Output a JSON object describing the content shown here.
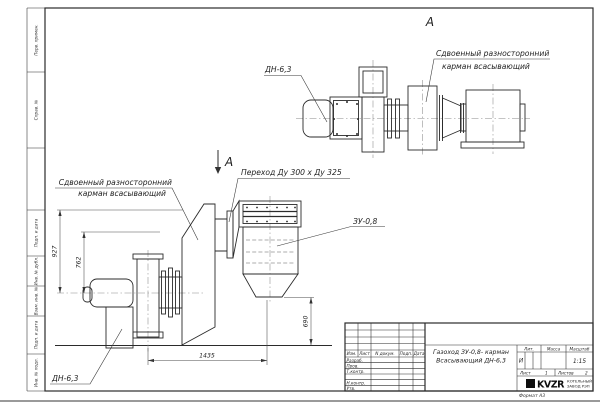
{
  "colors": {
    "ink": "#2b2b2b",
    "paper": "#ffffff"
  },
  "frame": {
    "side_columns": {
      "top": [
        "Перв. примен.",
        "Справ. №"
      ],
      "bottom": [
        "Подп. и дата",
        "Инв. № дубл.",
        "Взам. инв. №",
        "Подп. и дата",
        "Инв. № подл."
      ]
    },
    "format_note": "Формат  А3"
  },
  "drawing": {
    "view_label_top": "А",
    "section_label": "А",
    "labels": {
      "top_fan": "ДН-6,3",
      "top_pocket_line1": "Сдвоенный разносторонний",
      "top_pocket_line2": "карман всасывающий",
      "main_pocket_line1": "Сдвоенный разносторонний",
      "main_pocket_line2": "карман всасывающий",
      "transition": "Переход Ду  300 х  Ду 325",
      "collector": "ЗУ-0,8",
      "main_fan": "ДН-6,3"
    },
    "dimensions": {
      "total_height": "927",
      "duct_height": "762",
      "length": "1435",
      "outlet_height": "690"
    }
  },
  "title_block": {
    "title_line1": "Газоход ЗУ-0,8- карман",
    "title_line2": "Всасывающий ДН-6,3",
    "rev_header": [
      "Изм.",
      "Лист",
      "N докум.",
      "Подп.",
      "Дата"
    ],
    "row_labels": [
      "Разраб.",
      "Пров.",
      "Т.контр.",
      "Н.контр.",
      "Утв."
    ],
    "lit_label": "Лит.",
    "lit_value": "И",
    "mass_label": "Масса",
    "scale_label": "Масштаб",
    "scale_value": "1:15",
    "sheet_label": "Лист",
    "sheet_value": "1",
    "sheets_label": "Листов",
    "sheets_value": "2",
    "logo_text": "KVZR",
    "company_line1": "КОТЕЛЬНЫЙ",
    "company_line2": "ЗАВОД РЭП"
  }
}
